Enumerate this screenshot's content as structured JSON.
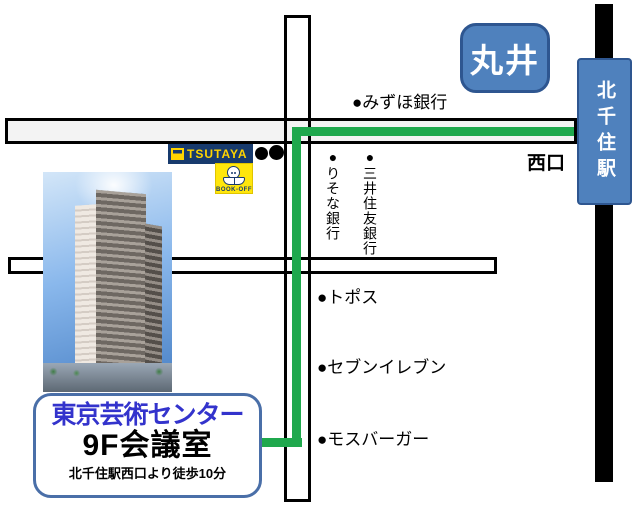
{
  "map": {
    "destination_box": {
      "name": "東京芸術センター",
      "room": "9F会議室",
      "access_note": "北千住駅西口より徒歩10分"
    },
    "station": {
      "name": "北千住駅",
      "west_exit": "西口"
    },
    "marui_label": "丸井",
    "landmarks": {
      "mizuho_bank": "●みずほ銀行",
      "resona_bank": "●りそな銀行",
      "smbc_bank": "●三井住友銀行",
      "topos": "●トポス",
      "seven_eleven": "●セブンイレブン",
      "mos_burger": "●モスバーガー"
    },
    "store_logos": {
      "tsutaya": "TSUTAYA",
      "book_off": "BOOK-OFF"
    },
    "colors": {
      "station_blue": "#4f81bd",
      "station_border": "#2e5690",
      "route_green": "#1fa84d",
      "tsutaya_navy": "#173a6d",
      "tsutaya_yellow": "#ffd400",
      "bookoff_yellow": "#ffe60c",
      "destination_title_blue": "#3333cc",
      "destination_box_border": "#4a6fa8",
      "railway_black": "#000000"
    }
  }
}
